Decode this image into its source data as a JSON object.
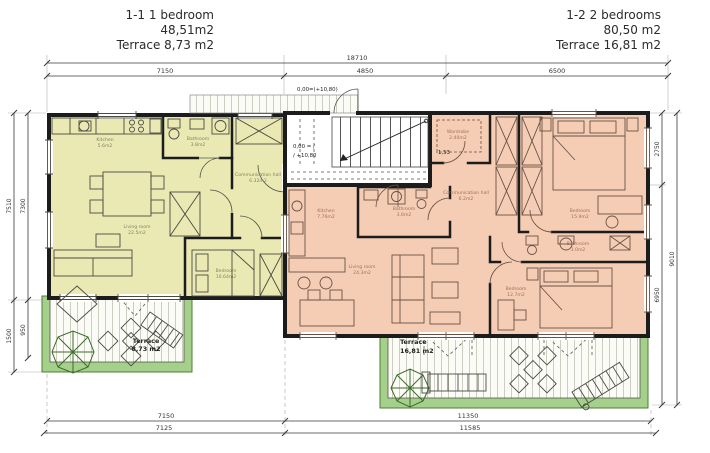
{
  "title_left": {
    "unit": "1-1  1 bedroom",
    "area": "48,51m2",
    "terrace": "Terrace 8,73 m2"
  },
  "title_right": {
    "unit": "1-2  2 bedrooms",
    "area": "80,50 m2",
    "terrace": "Terrace 16,81 m2"
  },
  "dims": {
    "top_total": "18710",
    "top_seg1": "7150",
    "top_seg2": "4850",
    "top_seg3": "6500",
    "bottom_row1_seg1": "7150",
    "bottom_row1_seg2": "11350",
    "bottom_row2_seg1": "7125",
    "bottom_row2_seg2": "11585",
    "left_outer_main": "7510",
    "left_outer_terrace": "1500",
    "left_inner_main": "7300",
    "left_inner_terrace": "950",
    "right_inner_top": "2750",
    "right_inner_bottom": "6950",
    "right_outer": "9010"
  },
  "levels": {
    "entrance": "0,00=(+10,80)",
    "stair_line1": "0,00 = /",
    "stair_line2": "/ +10,80",
    "landing": "-1,53"
  },
  "unit_left_rooms": {
    "kitchen": {
      "name": "Kitchen",
      "area": "5.6m2"
    },
    "bathroom": {
      "name": "Bathroom",
      "area": "3.8m2"
    },
    "hall": {
      "name": "Communication hall",
      "area": "6.32m2"
    },
    "living": {
      "name": "Living room",
      "area": "22.5m2"
    },
    "bedroom": {
      "name": "Bedroom",
      "area": "10.64m2"
    }
  },
  "unit_right_rooms": {
    "wardrobe": {
      "name": "Wardrobe",
      "area": "2.40m2"
    },
    "hall": {
      "name": "Communication hall",
      "area": "6.2m2"
    },
    "bedroom1": {
      "name": "Bedroom",
      "area": "15.9m2"
    },
    "kitchen": {
      "name": "Kitchen",
      "area": "7.76m2"
    },
    "bathroom1": {
      "name": "Bathroom",
      "area": "3.6m2"
    },
    "living": {
      "name": "Living room",
      "area": "24.3m2"
    },
    "bathroom2": {
      "name": "Bathroom",
      "area": "3.0m2"
    },
    "bedroom2": {
      "name": "Bedroom",
      "area": "12.7m2"
    }
  },
  "terrace_left": {
    "name": "Terrace",
    "area": "8,73 m2"
  },
  "terrace_right": {
    "name": "Terrace",
    "area": "16,81 m2"
  },
  "colors": {
    "unit_left": "#eae9b4",
    "unit_right": "#f5cdb4",
    "terrace_green": "#a5d08c",
    "wall": "#1c1c1c",
    "deck_plank": "#b9b9aa"
  }
}
